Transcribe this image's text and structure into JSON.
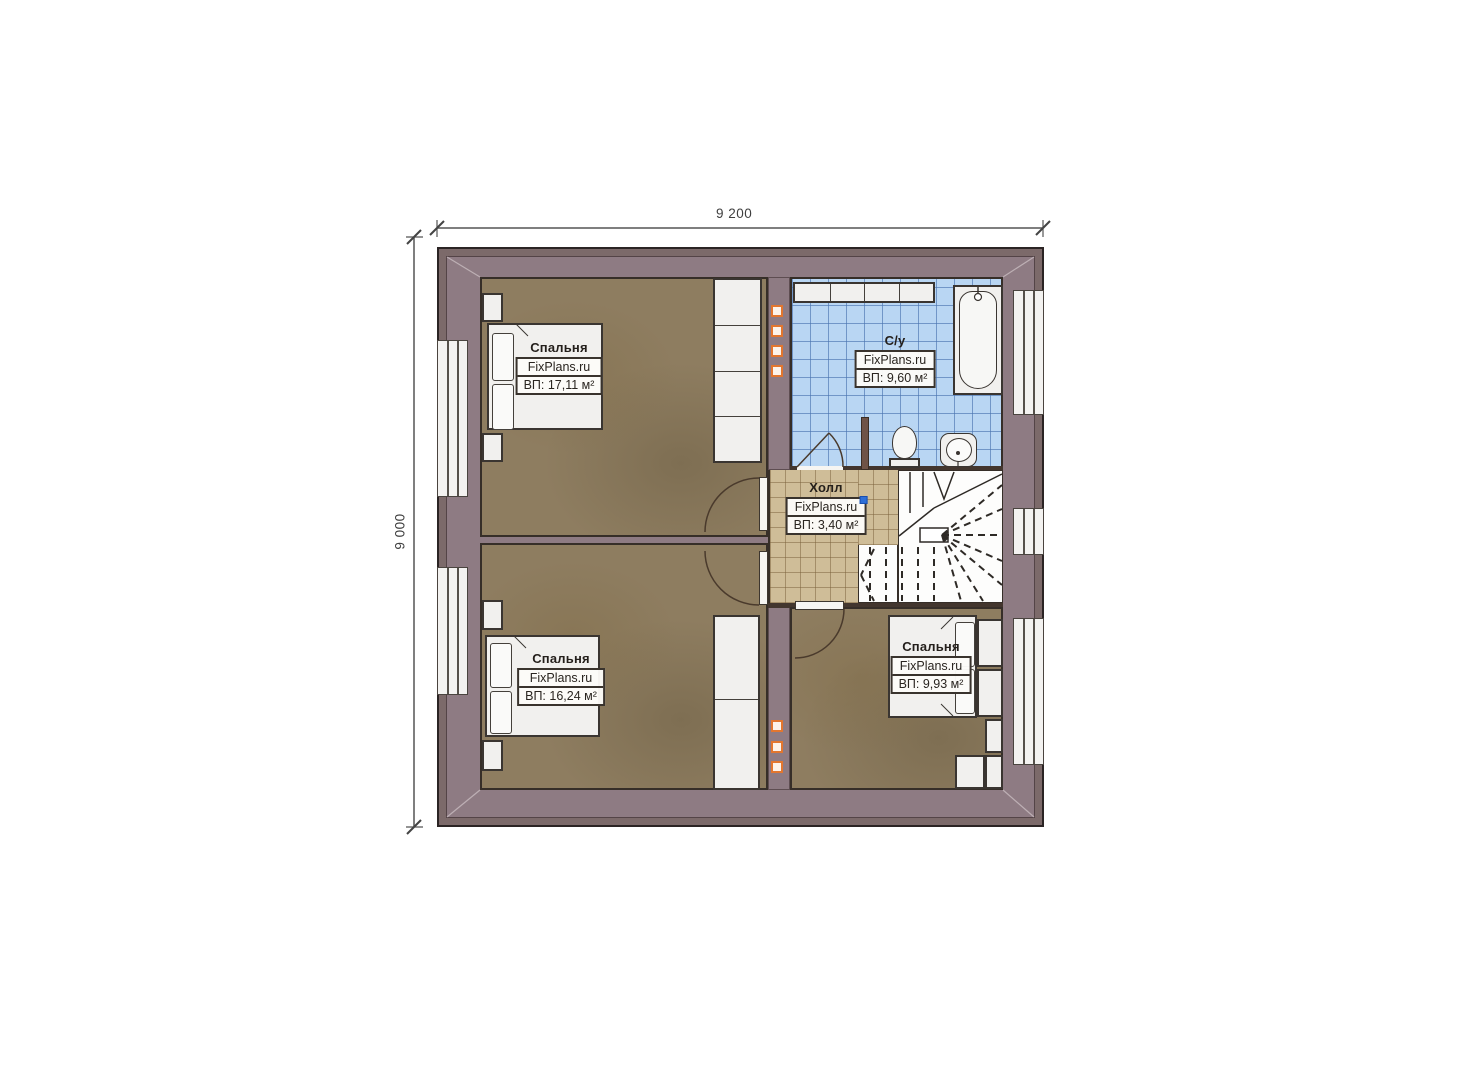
{
  "plan": {
    "dimensions": {
      "width": "9 200",
      "height": "9 000"
    },
    "rooms": {
      "bedroom_tl": {
        "name": "Спальня",
        "brand": "FixPlans.ru",
        "area": "ВП: 17,11 м²"
      },
      "bathroom": {
        "name": "С/у",
        "brand": "FixPlans.ru",
        "area": "ВП: 9,60 м²"
      },
      "hall": {
        "name": "Холл",
        "brand": "FixPlans.ru",
        "area": "ВП: 3,40 м²"
      },
      "bedroom_bl": {
        "name": "Спальня",
        "brand": "FixPlans.ru",
        "area": "ВП: 16,24 м²"
      },
      "bedroom_br": {
        "name": "Спальня",
        "brand": "FixPlans.ru",
        "area": "ВП: 9,93 м²"
      }
    },
    "colors": {
      "outer_wall": "#7c6a6a",
      "inner_wall": "#8e7b83",
      "bedroom_floor": "#8e7d60",
      "bath_tile": "#b9d6f3",
      "hall_tile": "#cfbd98",
      "accent_orange": "#e2762f",
      "marker_blue": "#2e6fd8"
    }
  }
}
